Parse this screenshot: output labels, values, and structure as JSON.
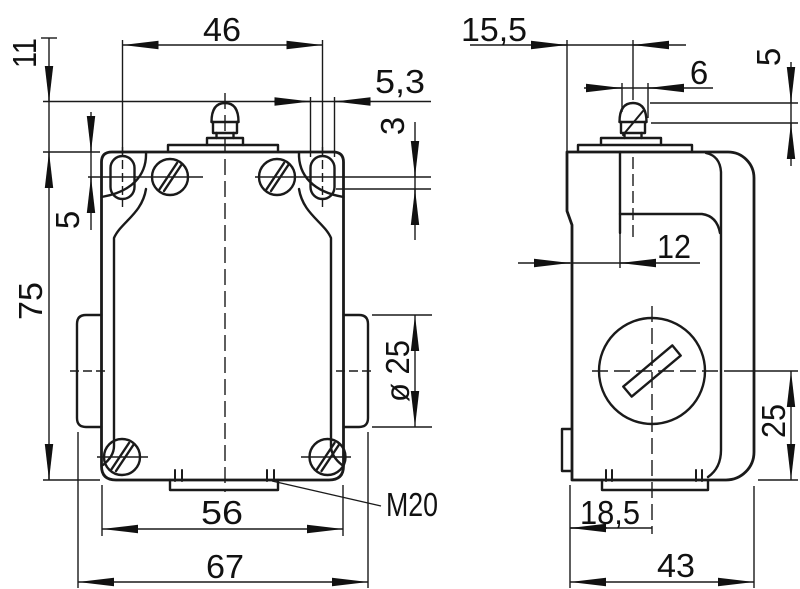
{
  "colors": {
    "line": "#1a1a1a",
    "background": "#ffffff",
    "text": "#111111"
  },
  "front_view": {
    "dims": {
      "hole_spacing": "46",
      "plunger_height": "11",
      "slot_width": "5,3",
      "slot_play": "3",
      "hole_offset": "5",
      "body_height": "75",
      "side_plug_dia": "ø 25",
      "bottom_width": "56",
      "cable_gland": "M20",
      "overall_width": "67"
    }
  },
  "side_view": {
    "dims": {
      "plunger_offset": "15,5",
      "plunger_dia": "6",
      "plunger_tip_height": "5",
      "head_step": "12",
      "head_center_height": "25",
      "gland_offset": "18,5",
      "overall_depth": "43"
    }
  }
}
